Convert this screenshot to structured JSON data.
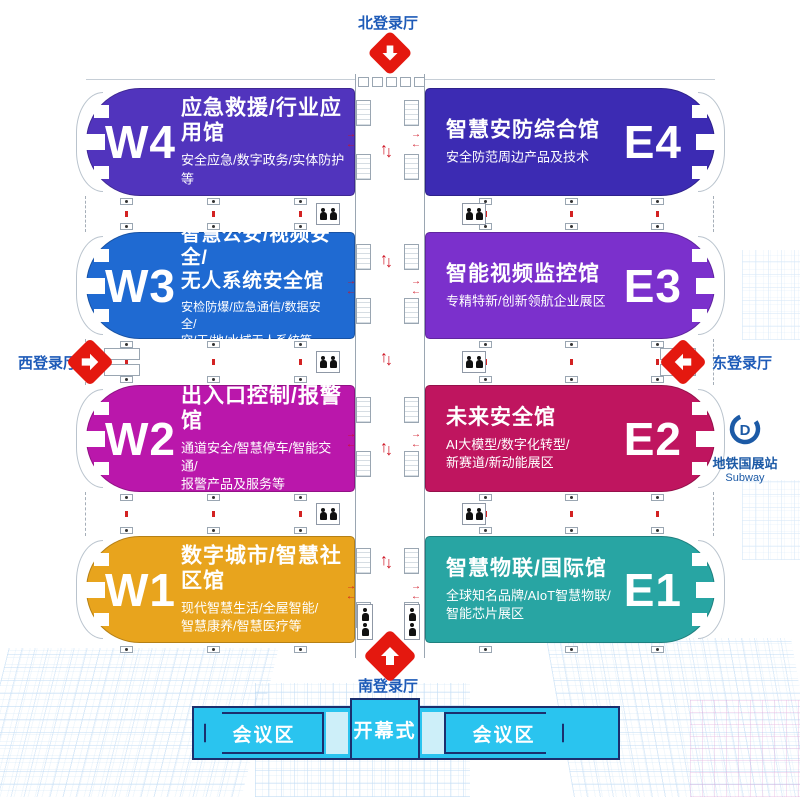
{
  "entrances": {
    "north": {
      "label": "北登录厅"
    },
    "south": {
      "label": "南登录厅"
    },
    "west": {
      "label": "西登录厅"
    },
    "east": {
      "label": "东登录厅"
    }
  },
  "subway": {
    "name": "地铁国展站",
    "name_en": "Subway"
  },
  "halls": [
    {
      "code": "W4",
      "title": "应急救援/行业应用馆",
      "desc": "安全应急/数字政务/实体防护等",
      "color": "#5134bd"
    },
    {
      "code": "E4",
      "title": "智慧安防综合馆",
      "desc": "安全防范周边产品及技术",
      "color": "#3c2bb3"
    },
    {
      "code": "W3",
      "title": "智慧公安/视频安全/\n无人系统安全馆",
      "desc": "安检防爆/应急通信/数据安全/\n空/天/地/水域无人系统等",
      "color": "#1f6ad2"
    },
    {
      "code": "E3",
      "title": "智能视频监控馆",
      "desc": "专精特新/创新领航企业展区",
      "color": "#7b30cc"
    },
    {
      "code": "W2",
      "title": "出入口控制/报警馆",
      "desc": "通道安全/智慧停车/智能交通/\n报警产品及服务等",
      "color": "#ba17ab"
    },
    {
      "code": "E2",
      "title": "未来安全馆",
      "desc": "AI大模型/数字化转型/\n新赛道/新动能展区",
      "color": "#bf155f"
    },
    {
      "code": "W1",
      "title": "数字城市/智慧社区馆",
      "desc": "现代智慧生活/全屋智能/\n智慧康养/智慧医疗等",
      "color": "#e8a41d"
    },
    {
      "code": "E1",
      "title": "智慧物联/国际馆",
      "desc": "全球知名品牌/AIoT智慧物联/\n智能芯片展区",
      "color": "#28a5a3"
    }
  ],
  "conference": {
    "left": "会议区",
    "center": "开幕式",
    "right": "会议区"
  },
  "icons": {
    "arrow_up": "↑",
    "arrow_down": "↓",
    "arrow_left": "←",
    "arrow_right": "→",
    "entrance_arrow": "direction-arrow-icon"
  },
  "colors": {
    "entrance_red": "#e4180f",
    "label_blue": "#1e5bb8",
    "subway_blue": "#1c5aa6",
    "conference_cyan": "#2ac4ef",
    "conference_border": "#1b2f6e"
  }
}
